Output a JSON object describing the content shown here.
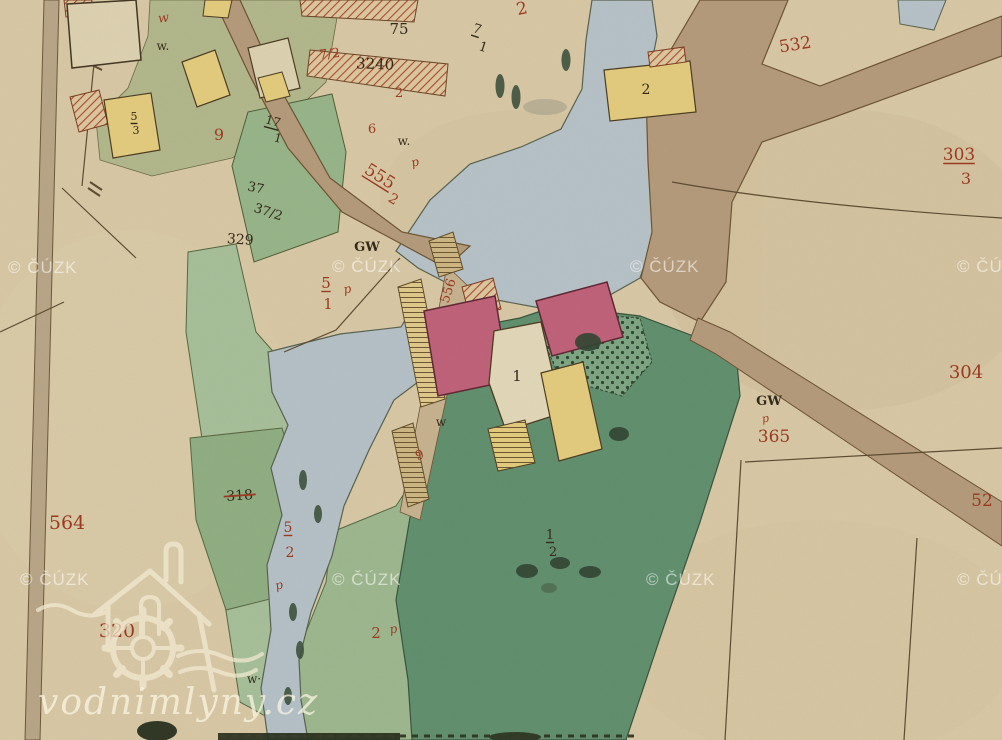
{
  "map": {
    "watermark": {
      "text": "© ČÚZK",
      "positions": [
        [
          8,
          273
        ],
        [
          332,
          272
        ],
        [
          630,
          272
        ],
        [
          957,
          272
        ],
        [
          20,
          585
        ],
        [
          332,
          585
        ],
        [
          646,
          585
        ],
        [
          957,
          585
        ]
      ]
    },
    "logo": {
      "site_text": "vodnimlyny.cz"
    },
    "label_colors": {
      "red": "#9b3a22",
      "black": "#342a1b"
    },
    "labels": [
      {
        "t": "2",
        "x": 523,
        "y": 14,
        "c": "red",
        "s": 17,
        "r": -12
      },
      {
        "t": "75",
        "x": 399,
        "y": 34,
        "c": "black",
        "s": 15
      },
      {
        "t": "7/2",
        "x": 330,
        "y": 58,
        "c": "red",
        "s": 13,
        "r": -6
      },
      {
        "t": "3240",
        "x": 375,
        "y": 69,
        "c": "black",
        "s": 15,
        "r": 2
      },
      {
        "t": "2",
        "x": 399,
        "y": 97,
        "c": "red",
        "s": 13
      },
      {
        "t": "7",
        "x": 476,
        "y": 33,
        "c": "black",
        "s": 13,
        "r": 18,
        "u": 1
      },
      {
        "t": "1",
        "x": 482,
        "y": 51,
        "c": "black",
        "s": 13,
        "r": 18
      },
      {
        "t": "w",
        "x": 164,
        "y": 22,
        "c": "red",
        "s": 13,
        "r": -8,
        "i": 1
      },
      {
        "t": "w.",
        "x": 163,
        "y": 50,
        "c": "black",
        "s": 12
      },
      {
        "t": "5",
        "x": 134,
        "y": 120,
        "c": "black",
        "s": 11,
        "u": 1
      },
      {
        "t": "3",
        "x": 136,
        "y": 134,
        "c": "black",
        "s": 11
      },
      {
        "t": "9",
        "x": 219,
        "y": 140,
        "c": "red",
        "s": 16
      },
      {
        "t": "17",
        "x": 272,
        "y": 125,
        "c": "black",
        "s": 12,
        "r": 15,
        "u": 1
      },
      {
        "t": "1",
        "x": 277,
        "y": 142,
        "c": "black",
        "s": 12,
        "r": 15
      },
      {
        "t": "2",
        "x": 646,
        "y": 94,
        "c": "black",
        "s": 14
      },
      {
        "t": "532",
        "x": 796,
        "y": 50,
        "c": "red",
        "s": 17,
        "r": -9
      },
      {
        "t": "303",
        "x": 959,
        "y": 160,
        "c": "red",
        "s": 17,
        "u": 1
      },
      {
        "t": "3",
        "x": 966,
        "y": 184,
        "c": "red",
        "s": 16
      },
      {
        "t": "6",
        "x": 372,
        "y": 133,
        "c": "red",
        "s": 13
      },
      {
        "t": "w.",
        "x": 404,
        "y": 145,
        "c": "black",
        "s": 12
      },
      {
        "t": "p",
        "x": 416,
        "y": 166,
        "c": "red",
        "s": 12,
        "r": -15,
        "i": 1
      },
      {
        "t": "555",
        "x": 377,
        "y": 181,
        "c": "red",
        "s": 17,
        "r": 32,
        "u": 1
      },
      {
        "t": "2",
        "x": 391,
        "y": 203,
        "c": "red",
        "s": 14,
        "r": 32
      },
      {
        "t": "GW",
        "x": 367,
        "y": 251,
        "c": "black",
        "s": 13,
        "b": 1
      },
      {
        "t": "37",
        "x": 255,
        "y": 192,
        "c": "black",
        "s": 13,
        "r": 12
      },
      {
        "t": "37/2",
        "x": 267,
        "y": 216,
        "c": "black",
        "s": 13,
        "r": 18
      },
      {
        "t": "329",
        "x": 240,
        "y": 244,
        "c": "black",
        "s": 14,
        "r": 4
      },
      {
        "t": "5",
        "x": 326,
        "y": 288,
        "c": "red",
        "s": 15,
        "u": 1
      },
      {
        "t": "1",
        "x": 328,
        "y": 309,
        "c": "red",
        "s": 15
      },
      {
        "t": "p",
        "x": 348,
        "y": 293,
        "c": "red",
        "s": 12,
        "r": -10,
        "i": 1
      },
      {
        "t": "556",
        "x": 452,
        "y": 292,
        "c": "red",
        "s": 13,
        "r": -72
      },
      {
        "t": "1",
        "x": 517,
        "y": 381,
        "c": "black",
        "s": 15
      },
      {
        "t": "w",
        "x": 441,
        "y": 426,
        "c": "black",
        "s": 12
      },
      {
        "t": "9",
        "x": 421,
        "y": 459,
        "c": "red",
        "s": 13,
        "r": -20
      },
      {
        "t": "GW",
        "x": 769,
        "y": 405,
        "c": "black",
        "s": 13,
        "b": 1
      },
      {
        "t": "p",
        "x": 766,
        "y": 422,
        "c": "red",
        "s": 11,
        "r": -10,
        "i": 1
      },
      {
        "t": "365",
        "x": 774,
        "y": 442,
        "c": "red",
        "s": 17
      },
      {
        "t": "304",
        "x": 966,
        "y": 378,
        "c": "red",
        "s": 18
      },
      {
        "t": "52",
        "x": 982,
        "y": 506,
        "c": "red",
        "s": 17
      },
      {
        "t": "564",
        "x": 67,
        "y": 529,
        "c": "red",
        "s": 19
      },
      {
        "t": "318",
        "x": 240,
        "y": 500,
        "c": "black",
        "s": 14,
        "r": -4,
        "st": 1
      },
      {
        "t": "5",
        "x": 288,
        "y": 532,
        "c": "red",
        "s": 14,
        "u": 1
      },
      {
        "t": "2",
        "x": 290,
        "y": 557,
        "c": "red",
        "s": 14
      },
      {
        "t": "p",
        "x": 280,
        "y": 589,
        "c": "red",
        "s": 12,
        "r": -15,
        "i": 1
      },
      {
        "t": "320",
        "x": 117,
        "y": 637,
        "c": "red",
        "s": 19
      },
      {
        "t": "2",
        "x": 376,
        "y": 638,
        "c": "red",
        "s": 15
      },
      {
        "t": "p",
        "x": 394,
        "y": 633,
        "c": "red",
        "s": 12,
        "r": -10,
        "i": 1
      },
      {
        "t": "1",
        "x": 550,
        "y": 539,
        "c": "black",
        "s": 13,
        "u": 1
      },
      {
        "t": "2",
        "x": 553,
        "y": 556,
        "c": "black",
        "s": 13
      },
      {
        "t": "w·",
        "x": 254,
        "y": 683,
        "c": "black",
        "s": 12
      }
    ]
  }
}
